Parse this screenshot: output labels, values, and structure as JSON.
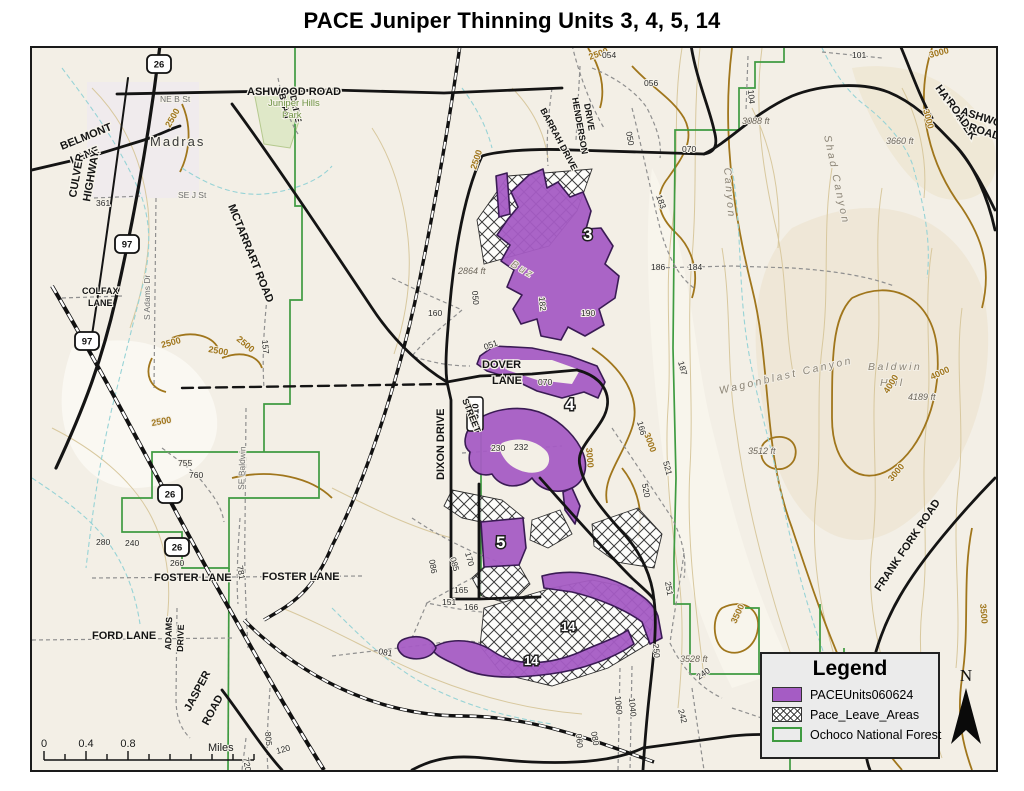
{
  "title": "PACE Juniper Thinning Units 3, 4, 5, 14",
  "legend": {
    "title": "Legend",
    "items": [
      {
        "label": "PACEUnits060624",
        "swatch": "units"
      },
      {
        "label": "Pace_Leave_Areas",
        "swatch": "leave"
      },
      {
        "label": "Ochoco National Forest",
        "swatch": "forest"
      }
    ]
  },
  "scale_bar": {
    "ticks": [
      "0",
      "0.4",
      "0.8"
    ],
    "unit": "Miles"
  },
  "north_arrow": {
    "label": "N"
  },
  "colors": {
    "unit_fill": "#a55cc4",
    "unit_border": "#3a1b54",
    "forest_green": "#3f9b41",
    "contour_light": "#d8c89e",
    "contour_index": "#a0761c",
    "stream": "#97d3d6",
    "road_black": "#141414",
    "minor_road": "#8f8f8f",
    "map_bg": "#f3efe6",
    "legend_bg": "#ebebeb"
  },
  "map": {
    "shields": [
      {
        "t": "26",
        "x": 127,
        "y": 16
      },
      {
        "t": "26",
        "x": 138,
        "y": 446
      },
      {
        "t": "26",
        "x": 145,
        "y": 499
      },
      {
        "t": "97",
        "x": 95,
        "y": 196
      },
      {
        "t": "97",
        "x": 55,
        "y": 293
      },
      {
        "t": "5310",
        "x": 443,
        "y": 366,
        "v": true
      }
    ],
    "labels": [
      {
        "t": "ASHWOOD ROAD",
        "x": 215,
        "y": 47,
        "c": "road"
      },
      {
        "t": "BELMONT",
        "x": 30,
        "y": 102,
        "r": -22,
        "c": "road"
      },
      {
        "t": "LANE",
        "x": 40,
        "y": 116,
        "r": -22,
        "c": "road"
      },
      {
        "t": "MCTARRART ROAD",
        "x": 196,
        "y": 158,
        "r": 68,
        "c": "road"
      },
      {
        "t": "BEAN",
        "x": 247,
        "y": 46,
        "r": 78,
        "c": "roadsm"
      },
      {
        "t": "DRIVE",
        "x": 258,
        "y": 48,
        "r": 78,
        "c": "roadsm"
      },
      {
        "t": "HENDERSON",
        "x": 540,
        "y": 50,
        "r": 80,
        "c": "roadsm"
      },
      {
        "t": "DRIVE",
        "x": 552,
        "y": 56,
        "r": 80,
        "c": "roadsm"
      },
      {
        "t": "BARRAH DRIVE",
        "x": 508,
        "y": 62,
        "r": 62,
        "c": "roadsm"
      },
      {
        "t": "HAY CREEK",
        "x": 903,
        "y": 40,
        "r": 55,
        "c": "road"
      },
      {
        "t": "ROAD",
        "x": 914,
        "y": 54,
        "r": 55,
        "c": "road"
      },
      {
        "t": "ASHWOOD",
        "x": 928,
        "y": 66,
        "r": 18,
        "c": "road"
      },
      {
        "t": "ROAD",
        "x": 936,
        "y": 82,
        "r": 18,
        "c": "road"
      },
      {
        "t": "CULVER",
        "x": 44,
        "y": 150,
        "r": -80,
        "c": "road"
      },
      {
        "t": "HIGHWAY",
        "x": 58,
        "y": 154,
        "r": -80,
        "c": "road"
      },
      {
        "t": "COLFAX",
        "x": 50,
        "y": 246,
        "c": "roadsm"
      },
      {
        "t": "LANE",
        "x": 56,
        "y": 258,
        "c": "roadsm"
      },
      {
        "t": "DOVER",
        "x": 450,
        "y": 320,
        "c": "road"
      },
      {
        "t": "LANE",
        "x": 460,
        "y": 336,
        "c": "road"
      },
      {
        "t": "DIXON DRIVE",
        "x": 412,
        "y": 432,
        "r": -90,
        "c": "road"
      },
      {
        "t": "STREET",
        "x": 430,
        "y": 352,
        "r": 68,
        "c": "roadsm"
      },
      {
        "t": "FOSTER LANE",
        "x": 122,
        "y": 533,
        "c": "road"
      },
      {
        "t": "FOSTER LANE",
        "x": 230,
        "y": 532,
        "c": "road"
      },
      {
        "t": "FORD LANE",
        "x": 60,
        "y": 591,
        "c": "road"
      },
      {
        "t": "ADAMS",
        "x": 139,
        "y": 602,
        "r": -88,
        "c": "roadsm"
      },
      {
        "t": "DRIVE",
        "x": 151,
        "y": 604,
        "r": -88,
        "c": "roadsm"
      },
      {
        "t": "JASPER",
        "x": 158,
        "y": 664,
        "r": -62,
        "c": "road"
      },
      {
        "t": "ROAD",
        "x": 176,
        "y": 678,
        "r": -62,
        "c": "road"
      },
      {
        "t": "FRANK FORK ROAD",
        "x": 848,
        "y": 544,
        "r": -56,
        "c": "road"
      },
      {
        "t": "NE B St",
        "x": 128,
        "y": 54,
        "c": "street"
      },
      {
        "t": "SE J St",
        "x": 146,
        "y": 150,
        "c": "street"
      },
      {
        "t": "S Adams Dr",
        "x": 118,
        "y": 272,
        "r": -90,
        "c": "street"
      },
      {
        "t": "SE Baldwin",
        "x": 212,
        "y": 442,
        "r": -88,
        "c": "street"
      },
      {
        "t": "Madras",
        "x": 118,
        "y": 98,
        "c": "town"
      },
      {
        "t": "Juniper Hills",
        "x": 236,
        "y": 58,
        "c": "park"
      },
      {
        "t": "Park",
        "x": 250,
        "y": 70,
        "c": "park"
      },
      {
        "t": "Wagonblast Canyon",
        "x": 688,
        "y": 346,
        "r": -13,
        "c": "canyon"
      },
      {
        "t": "Baldwin",
        "x": 836,
        "y": 322,
        "c": "canyon"
      },
      {
        "t": "Hill",
        "x": 848,
        "y": 338,
        "c": "canyon"
      },
      {
        "t": "Shad Canyon",
        "x": 792,
        "y": 88,
        "r": 78,
        "c": "canyon"
      },
      {
        "t": "Canyon",
        "x": 692,
        "y": 120,
        "r": 85,
        "c": "canyon"
      },
      {
        "t": "Buz",
        "x": 478,
        "y": 218,
        "r": 30,
        "c": "canyon"
      },
      {
        "t": "2864 ft",
        "x": 426,
        "y": 226,
        "c": "elev"
      },
      {
        "t": "3088 ft",
        "x": 710,
        "y": 76,
        "c": "elev"
      },
      {
        "t": "3660 ft",
        "x": 854,
        "y": 96,
        "c": "elev"
      },
      {
        "t": "3512 ft",
        "x": 716,
        "y": 406,
        "c": "elev"
      },
      {
        "t": "4189 ft",
        "x": 876,
        "y": 352,
        "c": "elev"
      },
      {
        "t": "3528 ft",
        "x": 648,
        "y": 614,
        "c": "elev"
      },
      {
        "t": "2500",
        "x": 138,
        "y": 80,
        "r": -60,
        "c": "contour"
      },
      {
        "t": "2500",
        "x": 444,
        "y": 122,
        "r": -72,
        "c": "contour"
      },
      {
        "t": "2500",
        "x": 130,
        "y": 300,
        "r": -15,
        "c": "contour"
      },
      {
        "t": "2500",
        "x": 176,
        "y": 304,
        "r": 10,
        "c": "contour"
      },
      {
        "t": "2500",
        "x": 204,
        "y": 292,
        "r": 40,
        "c": "contour"
      },
      {
        "t": "2500",
        "x": 120,
        "y": 378,
        "r": -10,
        "c": "contour"
      },
      {
        "t": "2500",
        "x": 558,
        "y": 12,
        "r": -20,
        "c": "contour"
      },
      {
        "t": "3000",
        "x": 554,
        "y": 400,
        "r": 85,
        "c": "contour"
      },
      {
        "t": "3000",
        "x": 612,
        "y": 386,
        "r": 70,
        "c": "contour"
      },
      {
        "t": "3000",
        "x": 898,
        "y": 10,
        "r": -15,
        "c": "contour"
      },
      {
        "t": "3000",
        "x": 891,
        "y": 62,
        "r": 75,
        "c": "contour"
      },
      {
        "t": "3000",
        "x": 860,
        "y": 434,
        "r": -50,
        "c": "contour"
      },
      {
        "t": "3500",
        "x": 948,
        "y": 556,
        "r": 85,
        "c": "contour"
      },
      {
        "t": "3500",
        "x": 704,
        "y": 576,
        "r": -65,
        "c": "contour"
      },
      {
        "t": "4000",
        "x": 856,
        "y": 346,
        "r": -58,
        "c": "contour"
      },
      {
        "t": "4000",
        "x": 900,
        "y": 332,
        "r": -25,
        "c": "contour"
      },
      {
        "t": "054",
        "x": 570,
        "y": 10,
        "c": "num"
      },
      {
        "t": "056",
        "x": 612,
        "y": 38,
        "c": "num"
      },
      {
        "t": "050",
        "x": 594,
        "y": 84,
        "r": 80,
        "c": "num"
      },
      {
        "t": "070",
        "x": 650,
        "y": 104,
        "c": "num"
      },
      {
        "t": "101",
        "x": 820,
        "y": 10,
        "c": "num"
      },
      {
        "t": "104",
        "x": 716,
        "y": 42,
        "r": 85,
        "c": "num"
      },
      {
        "t": "183",
        "x": 624,
        "y": 148,
        "r": 70,
        "c": "num"
      },
      {
        "t": "186",
        "x": 619,
        "y": 222,
        "c": "num"
      },
      {
        "t": "184",
        "x": 656,
        "y": 222,
        "c": "num"
      },
      {
        "t": "157",
        "x": 230,
        "y": 292,
        "r": 85,
        "c": "num"
      },
      {
        "t": "160",
        "x": 396,
        "y": 268,
        "c": "num"
      },
      {
        "t": "050",
        "x": 440,
        "y": 243,
        "r": 85,
        "c": "num"
      },
      {
        "t": "182",
        "x": 507,
        "y": 249,
        "r": 85,
        "c": "num"
      },
      {
        "t": "190",
        "x": 549,
        "y": 268,
        "c": "num"
      },
      {
        "t": "051",
        "x": 453,
        "y": 302,
        "r": -20,
        "c": "num"
      },
      {
        "t": "070",
        "x": 506,
        "y": 337,
        "c": "num"
      },
      {
        "t": "166",
        "x": 605,
        "y": 374,
        "r": 75,
        "c": "num"
      },
      {
        "t": "187",
        "x": 646,
        "y": 314,
        "r": 75,
        "c": "num"
      },
      {
        "t": "230",
        "x": 459,
        "y": 403,
        "c": "num"
      },
      {
        "t": "232",
        "x": 482,
        "y": 402,
        "c": "num"
      },
      {
        "t": "520",
        "x": 610,
        "y": 436,
        "r": 80,
        "c": "num"
      },
      {
        "t": "521",
        "x": 631,
        "y": 414,
        "r": 75,
        "c": "num"
      },
      {
        "t": "085",
        "x": 418,
        "y": 510,
        "r": 75,
        "c": "num"
      },
      {
        "t": "086",
        "x": 397,
        "y": 512,
        "r": 80,
        "c": "num"
      },
      {
        "t": "170",
        "x": 433,
        "y": 505,
        "r": 75,
        "c": "num"
      },
      {
        "t": "165",
        "x": 422,
        "y": 545,
        "c": "num"
      },
      {
        "t": "151",
        "x": 410,
        "y": 557,
        "c": "num"
      },
      {
        "t": "166",
        "x": 432,
        "y": 562,
        "c": "num"
      },
      {
        "t": "251",
        "x": 633,
        "y": 534,
        "r": 80,
        "c": "num"
      },
      {
        "t": "250",
        "x": 621,
        "y": 596,
        "r": 85,
        "c": "num"
      },
      {
        "t": "240",
        "x": 667,
        "y": 632,
        "r": -35,
        "c": "num"
      },
      {
        "t": "242",
        "x": 646,
        "y": 662,
        "r": 75,
        "c": "num"
      },
      {
        "t": "1040",
        "x": 597,
        "y": 650,
        "r": 85,
        "c": "num"
      },
      {
        "t": "1060",
        "x": 583,
        "y": 648,
        "r": 85,
        "c": "num"
      },
      {
        "t": "755",
        "x": 146,
        "y": 418,
        "c": "num"
      },
      {
        "t": "760",
        "x": 157,
        "y": 430,
        "c": "num"
      },
      {
        "t": "280",
        "x": 64,
        "y": 497,
        "c": "num"
      },
      {
        "t": "240",
        "x": 93,
        "y": 498,
        "c": "num"
      },
      {
        "t": "260",
        "x": 138,
        "y": 518,
        "c": "num"
      },
      {
        "t": "781",
        "x": 205,
        "y": 518,
        "r": 80,
        "c": "num"
      },
      {
        "t": "081",
        "x": 346,
        "y": 606,
        "r": 10,
        "c": "num"
      },
      {
        "t": "805",
        "x": 233,
        "y": 684,
        "r": 85,
        "c": "num"
      },
      {
        "t": "720",
        "x": 211,
        "y": 710,
        "r": 80,
        "c": "num"
      },
      {
        "t": "120",
        "x": 245,
        "y": 706,
        "r": -15,
        "c": "num"
      },
      {
        "t": "080",
        "x": 559,
        "y": 684,
        "r": 80,
        "c": "num"
      },
      {
        "t": "060",
        "x": 544,
        "y": 686,
        "r": 85,
        "c": "num"
      },
      {
        "t": "361",
        "x": 64,
        "y": 158,
        "c": "num"
      },
      {
        "t": "3",
        "x": 551,
        "y": 192,
        "c": "unit",
        "s": 17
      },
      {
        "t": "4",
        "x": 533,
        "y": 362,
        "c": "unit",
        "s": 17
      },
      {
        "t": "5",
        "x": 464,
        "y": 500,
        "c": "unit",
        "s": 17
      },
      {
        "t": "14",
        "x": 529,
        "y": 583,
        "c": "unit",
        "s": 13
      },
      {
        "t": "14",
        "x": 492,
        "y": 617,
        "c": "unit",
        "s": 13
      }
    ]
  }
}
